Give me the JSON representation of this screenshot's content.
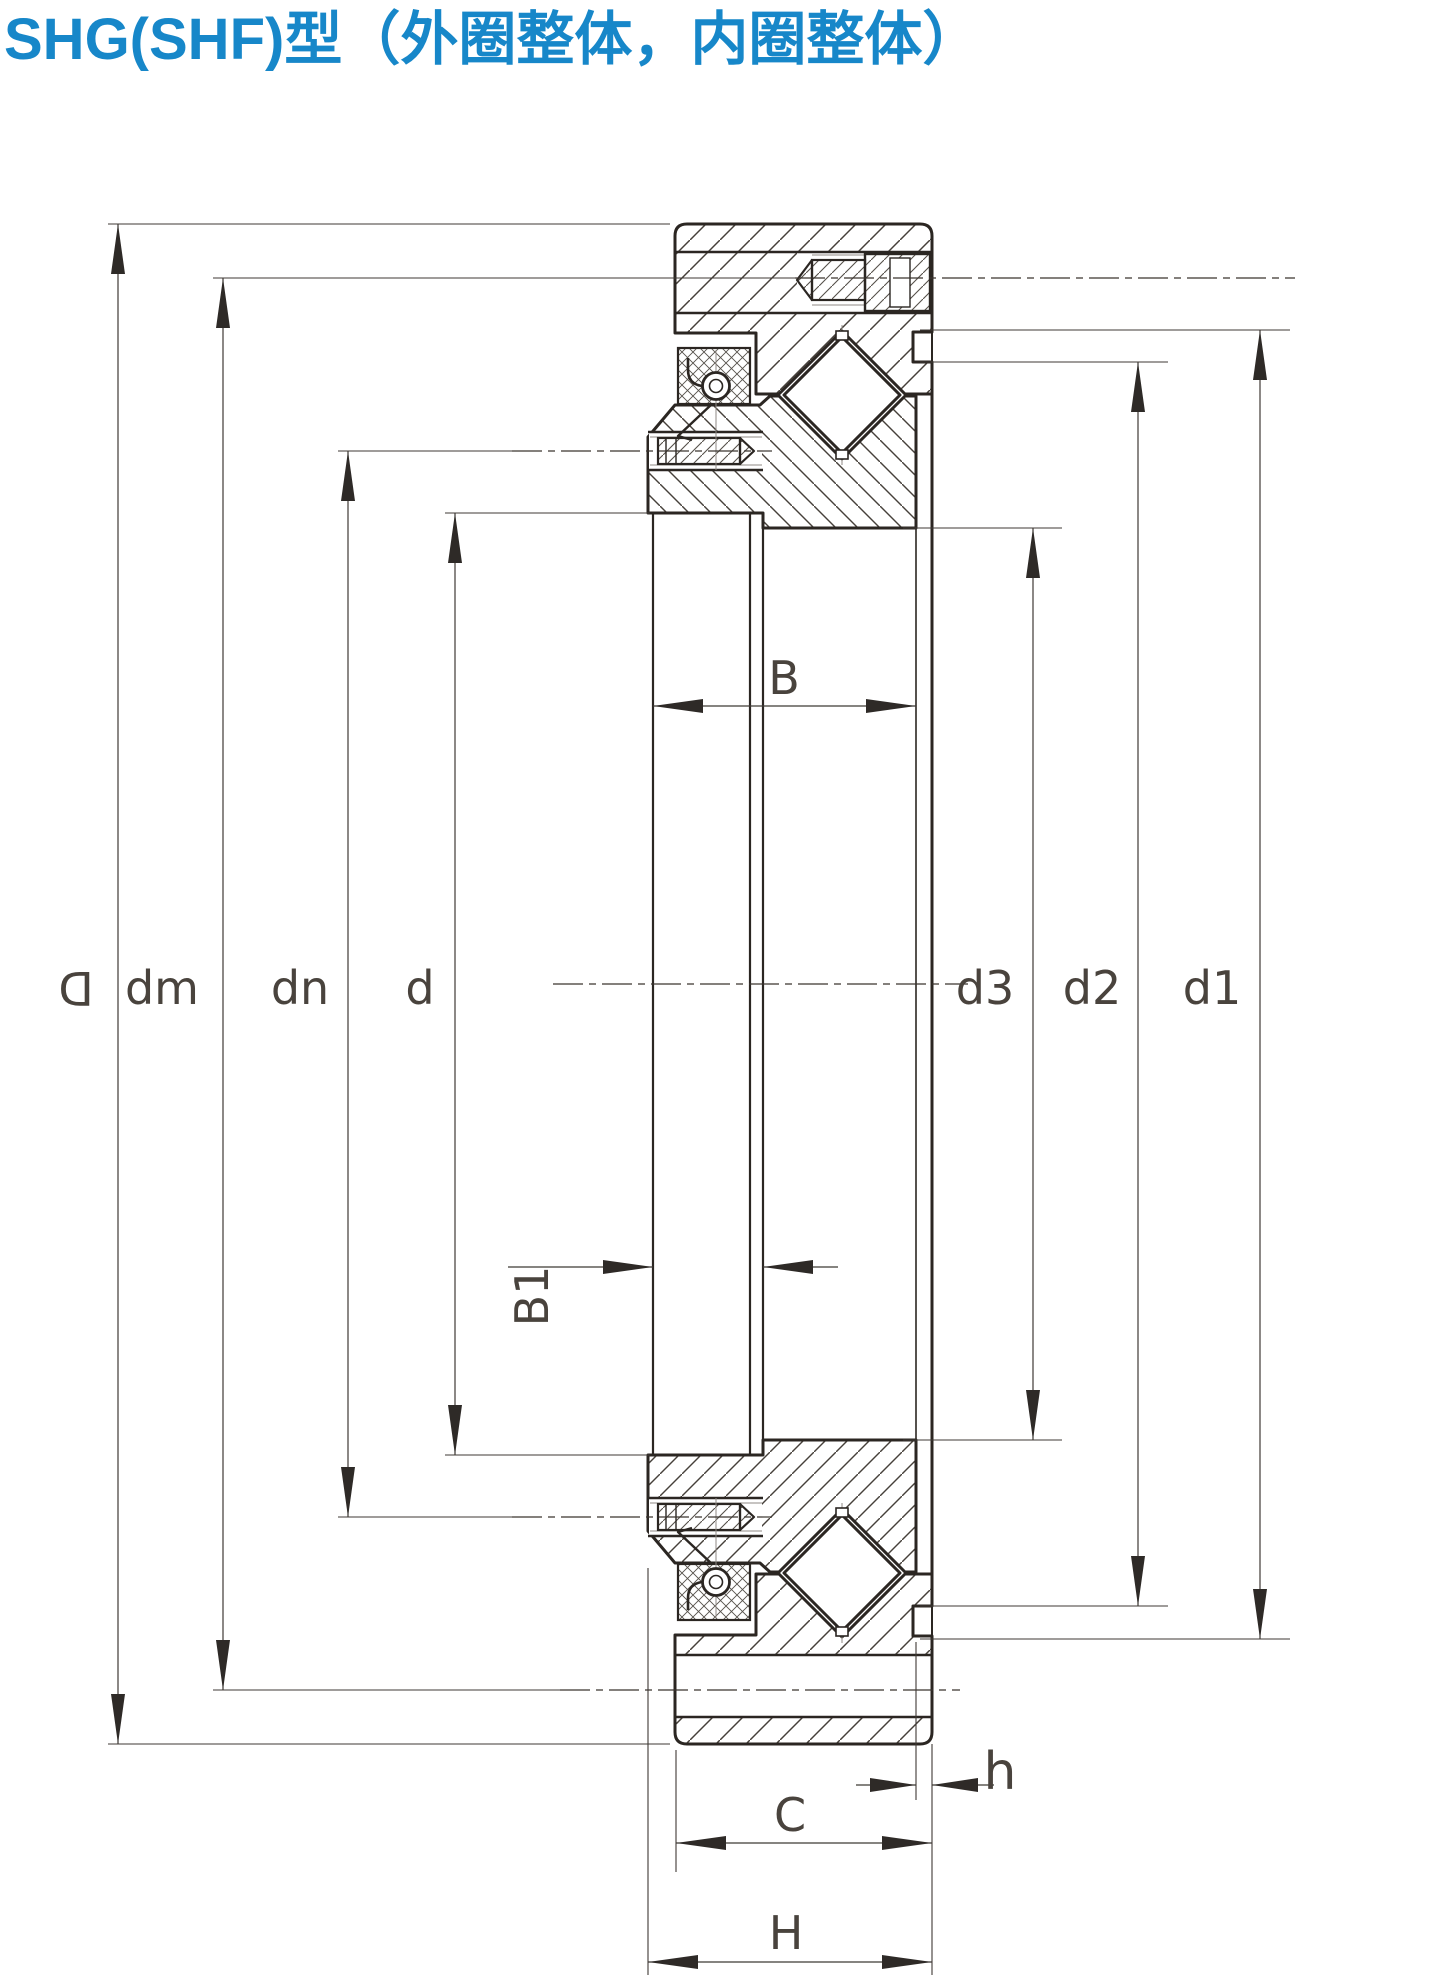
{
  "title": {
    "text": "SHG(SHF)型（外圈整体，内圈整体）",
    "color": "#1787c9"
  },
  "drawing": {
    "type": "technical-section-drawing",
    "subject": "SHG(SHF) crossed roller bearing, outer ring solid, inner ring solid",
    "line_color": "#35302b",
    "dimension_labels": {
      "D": "D",
      "dm": "dm",
      "dn": "dn",
      "d": "d",
      "d3": "d3",
      "d2": "d2",
      "d1": "d1",
      "B": "B",
      "B1": "B1",
      "C": "C",
      "h": "h",
      "H": "H"
    }
  }
}
